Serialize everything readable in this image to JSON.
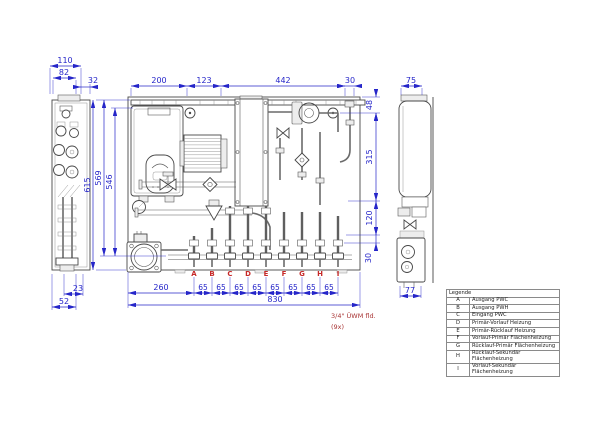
{
  "colors": {
    "dimension_blue": "#2626c9",
    "connection_red": "#c62828",
    "note_red": "#a83434",
    "drawing_line": "#474747"
  },
  "dimensions": {
    "left_view": {
      "total_width": "110",
      "inner_width": "82",
      "gap": "32",
      "bottom_offset": "23",
      "bottom_width": "52"
    },
    "top_chain": [
      "200",
      "123",
      "442",
      "30"
    ],
    "heights": {
      "total": "615",
      "rail": "569",
      "inner": "546"
    },
    "right_chain": [
      "48",
      "315",
      "120",
      "30"
    ],
    "right_view": {
      "top_width": "75",
      "bottom_width": "77"
    },
    "bottom": {
      "left_offset": "260",
      "pitch": [
        "65",
        "65",
        "65",
        "65",
        "65",
        "65",
        "65",
        "65"
      ],
      "total_width": "830"
    }
  },
  "connections": [
    "A",
    "B",
    "C",
    "D",
    "E",
    "F",
    "G",
    "H",
    "I"
  ],
  "note": {
    "line1": "3/4\" ÜWM fld.",
    "line2": "(9x)"
  },
  "legend": {
    "title": "Legende",
    "rows": [
      {
        "key": "A",
        "label": "Ausgang PWC"
      },
      {
        "key": "B",
        "label": "Ausgang PWH"
      },
      {
        "key": "C",
        "label": "Eingang PWC"
      },
      {
        "key": "D",
        "label": "Primär-Vorlauf Heizung"
      },
      {
        "key": "E",
        "label": "Primär-Rücklauf Heizung"
      },
      {
        "key": "F",
        "label": "Vorlauf-Primär Flächenheizung"
      },
      {
        "key": "G",
        "label": "Rücklauf-Primär Flächenheizung"
      },
      {
        "key": "H",
        "label": "Rücklauf-Sekundär Flächenheizung"
      },
      {
        "key": "I",
        "label": "Vorlauf-Sekundär Flächenheizung"
      }
    ]
  }
}
